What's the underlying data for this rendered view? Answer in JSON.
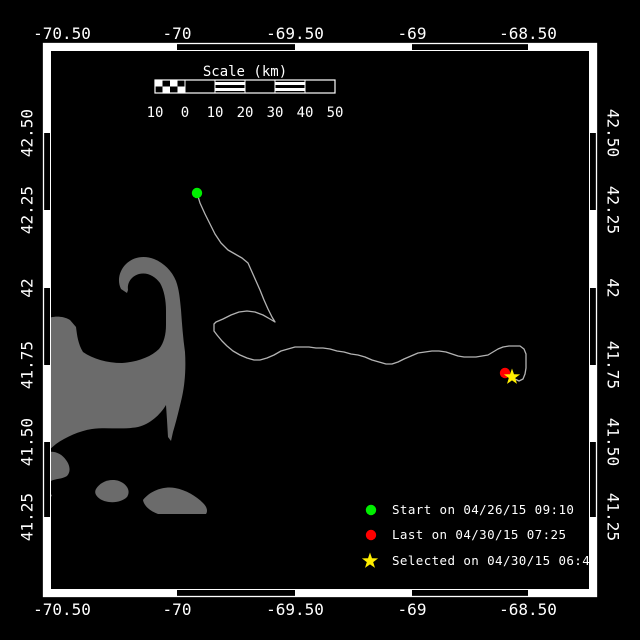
{
  "axes": {
    "top": [
      "-70.50",
      "-70",
      "-69.50",
      "-69",
      "-68.50"
    ],
    "bottom": [
      "-70.50",
      "-70",
      "-69.50",
      "-69",
      "-68.50"
    ],
    "left": [
      "42.50",
      "42.25",
      "42",
      "41.75",
      "41.50",
      "41.25"
    ],
    "right": [
      "42.50",
      "42.25",
      "42",
      "41.75",
      "41.50",
      "41.25"
    ]
  },
  "scale_bar": {
    "title": "Scale (km)",
    "labels": [
      "10",
      "0",
      "10",
      "20",
      "30",
      "40",
      "50"
    ]
  },
  "legend": [
    {
      "icon": "circle",
      "color": "#00ee00",
      "label": "Start on 04/26/15 09:10"
    },
    {
      "icon": "circle",
      "color": "#ff0000",
      "label": "Last on 04/30/15 07:25"
    },
    {
      "icon": "star",
      "color": "#ffee00",
      "label": "Selected on 04/30/15 06:40"
    }
  ],
  "markers": {
    "start_color": "#00ee00",
    "last_color": "#ff0000",
    "selected_color": "#ffee00"
  },
  "colors": {
    "background": "#000000",
    "frame": "#ffffff",
    "land": "#6b6b6b",
    "track": "#b3b3b3"
  },
  "track": {
    "points": "197,193 200,203 205,214 210,224 215,234 221,243 228,250 235,254 242,258 248,263 252,272 256,281 260,290 264,300 268,309 272,317 275,322 270,319 263,315 255,312 247,311 239,312 231,315 223,319 216,322 214,324 214,331 217,335 222,341 227,346 233,351 240,355 247,358 254,360 260,360 267,358 274,355 281,351 288,349 295,347 302,347 309,347 316,348 323,348 330,349 337,351 344,352 351,354 358,355 365,357 372,360 379,362 386,364 392,364 398,362 404,359 411,356 418,353 425,352 432,351 439,351 446,352 452,354 458,356 464,357 470,357 476,357 482,356 488,355 493,352 498,349 503,347 509,346 515,346 520,346 524,349 526,354 526,361 526,368 525,374 523,379 519,381 515,379 512,377"
  }
}
